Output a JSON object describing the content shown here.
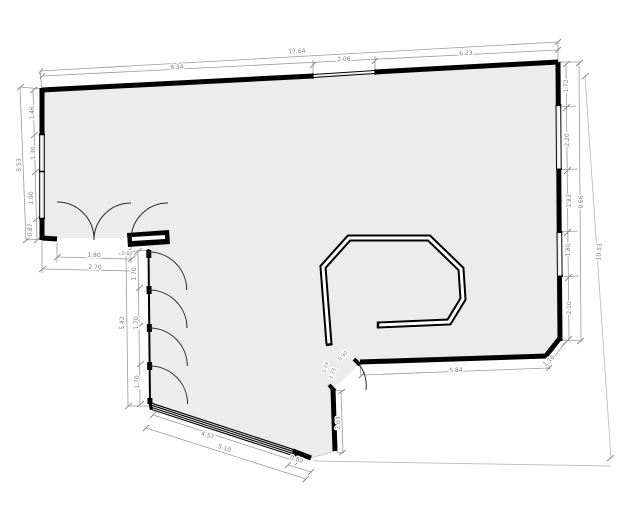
{
  "drawing": {
    "type": "architectural floor plan",
    "units_style": "decimal meters"
  },
  "colors": {
    "wall": "#000000",
    "floor": "#ececec",
    "dimension_line": "#9a9a9a",
    "dimension_text": "#7f7f7f",
    "site_line": "#bdbdbd"
  },
  "dims": {
    "top_total": "17.64",
    "top_left": "9.34",
    "top_opening": "2.06",
    "top_right": "6.23",
    "left_total": "5.53",
    "left_s1": "1.46",
    "left_s2": "1.30",
    "left_s3": "1.90",
    "left_s4": "0.87",
    "entry_door": "1.80",
    "entry_total": "2.70",
    "entry_stub": "0.60",
    "col_d1": "1.70",
    "col_d2": "1.70",
    "col_d3": "1.70",
    "col_total": "5.42",
    "bottom_window": "4.57",
    "bottom_total": "5.10",
    "bottom_end": "0.80",
    "notch_height": "2.03",
    "interior_bottom": "5.84",
    "interior_corner": "1.16",
    "interior_door": "0.90",
    "interior_a": "1.74",
    "interior_b": "1.23",
    "right_s1": "1.72",
    "right_s2": "2.20",
    "right_s3": "1.83",
    "right_s4": "1.80",
    "right_s5": "2.10",
    "right_total": "9.66",
    "site_total": "10.53"
  }
}
